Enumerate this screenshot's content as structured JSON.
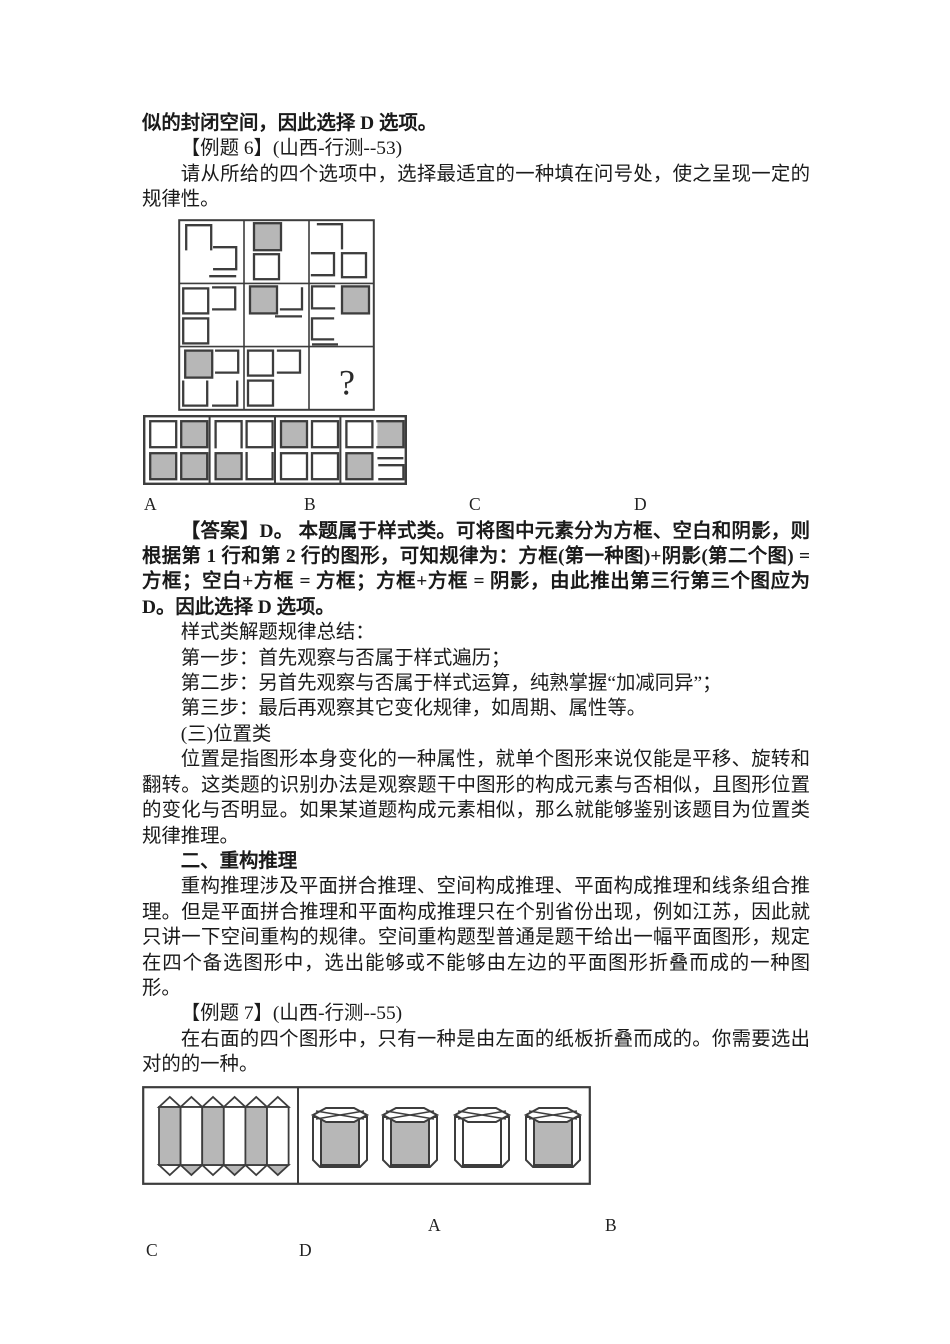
{
  "colors": {
    "shade": "#b7b7b7",
    "stroke": "#3d3d3d",
    "text": "#1a1a1a"
  },
  "example6": {
    "context_line": "似的封闭空间，因此选择 D 选项。",
    "title": "【例题 6】(山西-行测--53)",
    "prompt": "请从所给的四个选项中，选择最适宜的一种填在问号处，使之呈现一定的规律性。",
    "grid": {
      "question_mark": "?",
      "cells": [
        [
          {
            "t": "ob",
            "x": 7,
            "y": 5,
            "w": 25,
            "h": 24
          },
          {
            "t": "ol",
            "x": 35,
            "y": 27,
            "w": 22,
            "h": 22
          },
          {
            "t": "hl",
            "x": 30,
            "y": 56,
            "w": 27
          }
        ],
        [
          {
            "t": "sh",
            "x": 10,
            "y": 3,
            "w": 27,
            "h": 27
          },
          {
            "t": "sq",
            "x": 10,
            "y": 34,
            "w": 25,
            "h": 25
          }
        ],
        [
          {
            "t": "ctr",
            "x": 9,
            "y": 4,
            "w": 24,
            "h": 24
          },
          {
            "t": "ol",
            "x": 3,
            "y": 33,
            "w": 22,
            "h": 22
          },
          {
            "t": "sq",
            "x": 33,
            "y": 33,
            "w": 24,
            "h": 24
          }
        ],
        [
          {
            "t": "sq",
            "x": 4,
            "y": 5,
            "w": 25,
            "h": 25
          },
          {
            "t": "ol",
            "x": 34,
            "y": 4,
            "w": 22,
            "h": 22
          },
          {
            "t": "sq",
            "x": 4,
            "y": 35,
            "w": 25,
            "h": 25
          }
        ],
        [
          {
            "t": "sh",
            "x": 6,
            "y": 3,
            "w": 27,
            "h": 27
          },
          {
            "t": "cbr",
            "x": 37,
            "y": 5,
            "w": 21,
            "h": 21
          },
          {
            "t": "hl",
            "x": 31,
            "y": 33,
            "w": 27
          }
        ],
        [
          {
            "t": "or",
            "x": 3,
            "y": 3,
            "w": 22,
            "h": 22
          },
          {
            "t": "sh",
            "x": 33,
            "y": 3,
            "w": 27,
            "h": 27
          },
          {
            "t": "or",
            "x": 3,
            "y": 35,
            "w": 21,
            "h": 21
          },
          {
            "t": "hl",
            "x": 3,
            "y": 61,
            "w": 26
          }
        ],
        [
          {
            "t": "sh",
            "x": 6,
            "y": 4,
            "w": 27,
            "h": 27
          },
          {
            "t": "ol",
            "x": 37,
            "y": 4,
            "w": 22,
            "h": 22
          },
          {
            "t": "ot",
            "x": 4,
            "y": 35,
            "w": 24,
            "h": 24
          },
          {
            "t": "cbr",
            "x": 34,
            "y": 35,
            "w": 24,
            "h": 24
          }
        ],
        [
          {
            "t": "sq",
            "x": 4,
            "y": 4,
            "w": 25,
            "h": 25
          },
          {
            "t": "ol",
            "x": 34,
            "y": 4,
            "w": 22,
            "h": 22
          },
          {
            "t": "sq",
            "x": 4,
            "y": 34,
            "w": 25,
            "h": 25
          }
        ],
        [
          {
            "t": "q",
            "x": 30,
            "y": 48
          }
        ]
      ]
    },
    "options": [
      {
        "label": "A",
        "shapes": [
          {
            "t": "sq",
            "x": 6,
            "y": 5,
            "w": 26,
            "h": 26
          },
          {
            "t": "sh",
            "x": 37,
            "y": 5,
            "w": 26,
            "h": 26
          },
          {
            "t": "sh",
            "x": 6,
            "y": 37,
            "w": 26,
            "h": 26
          },
          {
            "t": "sh",
            "x": 37,
            "y": 37,
            "w": 26,
            "h": 26
          }
        ]
      },
      {
        "label": "B",
        "shapes": [
          {
            "t": "ob",
            "x": 6,
            "y": 5,
            "w": 26,
            "h": 26
          },
          {
            "t": "sq",
            "x": 37,
            "y": 5,
            "w": 26,
            "h": 26
          },
          {
            "t": "sh",
            "x": 6,
            "y": 37,
            "w": 26,
            "h": 26
          },
          {
            "t": "ot",
            "x": 37,
            "y": 37,
            "w": 26,
            "h": 26
          }
        ]
      },
      {
        "label": "C",
        "shapes": [
          {
            "t": "sh",
            "x": 6,
            "y": 5,
            "w": 26,
            "h": 26
          },
          {
            "t": "sq",
            "x": 37,
            "y": 5,
            "w": 26,
            "h": 26
          },
          {
            "t": "sq",
            "x": 6,
            "y": 37,
            "w": 26,
            "h": 26
          },
          {
            "t": "sq",
            "x": 37,
            "y": 37,
            "w": 26,
            "h": 26
          }
        ]
      },
      {
        "label": "D",
        "shapes": [
          {
            "t": "sq",
            "x": 6,
            "y": 5,
            "w": 26,
            "h": 26
          },
          {
            "t": "shl",
            "x": 37,
            "y": 5,
            "w": 26,
            "h": 26
          },
          {
            "t": "sh",
            "x": 6,
            "y": 37,
            "w": 26,
            "h": 26
          },
          {
            "t": "hl",
            "x": 37,
            "y": 42,
            "w": 26
          },
          {
            "t": "ol",
            "x": 39,
            "y": 49,
            "w": 24,
            "h": 14
          }
        ]
      }
    ],
    "option_labels": [
      "A",
      "B",
      "C",
      "D"
    ],
    "answer": "【答案】D。 本题属于样式类。可将图中元素分为方框、空白和阴影，则根据第 1 行和第 2 行的图形，可知规律为：方框(第一种图)+阴影(第二个图) = 方框；空白+方框 = 方框；方框+方框 = 阴影，由此推出第三行第三个图应为 D。因此选择 D 选项。"
  },
  "summary": {
    "heading": "样式类解题规律总结：",
    "steps": [
      "第一步：首先观察与否属于样式遍历；",
      "第二步：另首先观察与否属于样式运算，纯熟掌握“加减同异”；",
      "第三步：最后再观察其它变化规律，如周期、属性等。"
    ]
  },
  "position_section": {
    "heading": "(三)位置类",
    "body": "位置是指图形本身变化的一种属性，就单个图形来说仅能是平移、旋转和翻转。这类题的识别办法是观察题干中图形的构成元素与否相似，且图形位置的变化与否明显。如果某道题构成元素相似，那么就能够鉴别该题目为位置类规律推理。"
  },
  "restructure_section": {
    "heading": "二、重构推理",
    "body": "重构推理涉及平面拼合推理、空间构成推理、平面构成推理和线条组合推理。但是平面拼合推理和平面构成推理只在个别省份出现，例如江苏，因此就只讲一下空间重构的规律。空间重构题型普通是题干给出一幅平面图形，规定在四个备选图形中，选出能够或不能够由左边的平面图形折叠而成的一种图形。"
  },
  "example7": {
    "title": "【例题 7】(山西-行测--55)",
    "prompt": "在右面的四个图形中，只有一种是由左面的纸板折叠而成的。你需要选出对的的一种。",
    "figure": {
      "strip": {
        "columns": [
          "shaded",
          "white",
          "shaded",
          "white",
          "shaded",
          "white"
        ],
        "top_triangles": [
          "white",
          "white",
          "white",
          "white",
          "white",
          "white"
        ],
        "bottom_triangles": [
          "white",
          "shaded",
          "white",
          "shaded",
          "white",
          "shaded"
        ]
      },
      "prisms": [
        {
          "front": "shaded"
        },
        {
          "front": "shaded"
        },
        {
          "front": "white"
        },
        {
          "front": "shaded"
        }
      ]
    },
    "option_labels": [
      "A",
      "B",
      "C",
      "D"
    ]
  }
}
